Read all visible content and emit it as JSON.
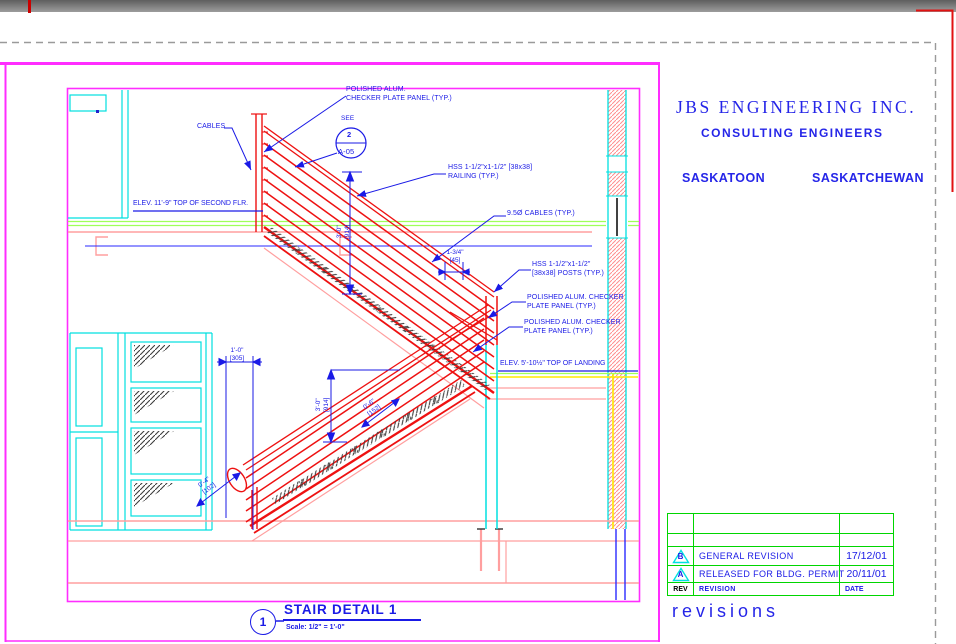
{
  "sheet": {
    "company": "JBS ENGINEERING INC.",
    "company_subtitle": "CONSULTING ENGINEERS",
    "company_city": "SASKATOON",
    "company_province": "SASKATCHEWAN"
  },
  "detail": {
    "number": "1",
    "title": "STAIR DETAIL 1",
    "scale": "Scale: 1/2\" = 1'-0\""
  },
  "callout": {
    "see": "SEE",
    "number": "2",
    "sheet": "A-05"
  },
  "notes": {
    "panel_top": "POLISHED ALUM.\nCHECKER PLATE PANEL (TYP.)",
    "cables": "CABLES",
    "railing": "HSS 1-1/2\"x1-1/2\" [38x38]\nRAILING (TYP.)",
    "cable_dia": "9.5Ø CABLES (TYP.)",
    "posts": "HSS 1-1/2\"x1-1/2\"\n[38x38] POSTS (TYP.)",
    "panel_mid_1": "POLISHED ALUM. CHECKER\nPLATE PANEL (TYP.)",
    "panel_mid_2": "POLISHED ALUM. CHECKER\nPLATE PANEL (TYP.)",
    "elev_second_floor": "ELEV. 11'-9\" TOP OF SECOND FLR.",
    "elev_landing": "ELEV. 5'-10½\" TOP OF LANDING"
  },
  "dimensions": {
    "rail_height_upper": "3'-0\"\n[914]",
    "rail_height_lower": "3'-0\"\n[914]",
    "offset_1_34": "1-3/4\"\n[45]",
    "clear_1ft": "1'-0\"\n[305]",
    "spacing_6in": "0'-6\"\n[152]",
    "spacing_4in": "0'-4\"\n[102]"
  },
  "revisions": {
    "label": "revisions",
    "headers": {
      "rev": "REV",
      "revision": "REVISION",
      "date": "DATE"
    },
    "rows": [
      {
        "mark": "B",
        "description": "GENERAL REVISION",
        "date": "17/12/01"
      },
      {
        "mark": "A",
        "description": "RELEASED FOR BLDG. PERMIT",
        "date": "20/11/01"
      }
    ]
  },
  "colors": {
    "sheet_border_magenta": "#ff2dff",
    "steel_red": "#ee1111",
    "wall_cyan": "#00e0e0",
    "table_green": "#00d600",
    "annotation_blue": "#1a1ae6",
    "concrete_salmon": "#ff9f9f",
    "finish_yellow": "#ffe800"
  }
}
